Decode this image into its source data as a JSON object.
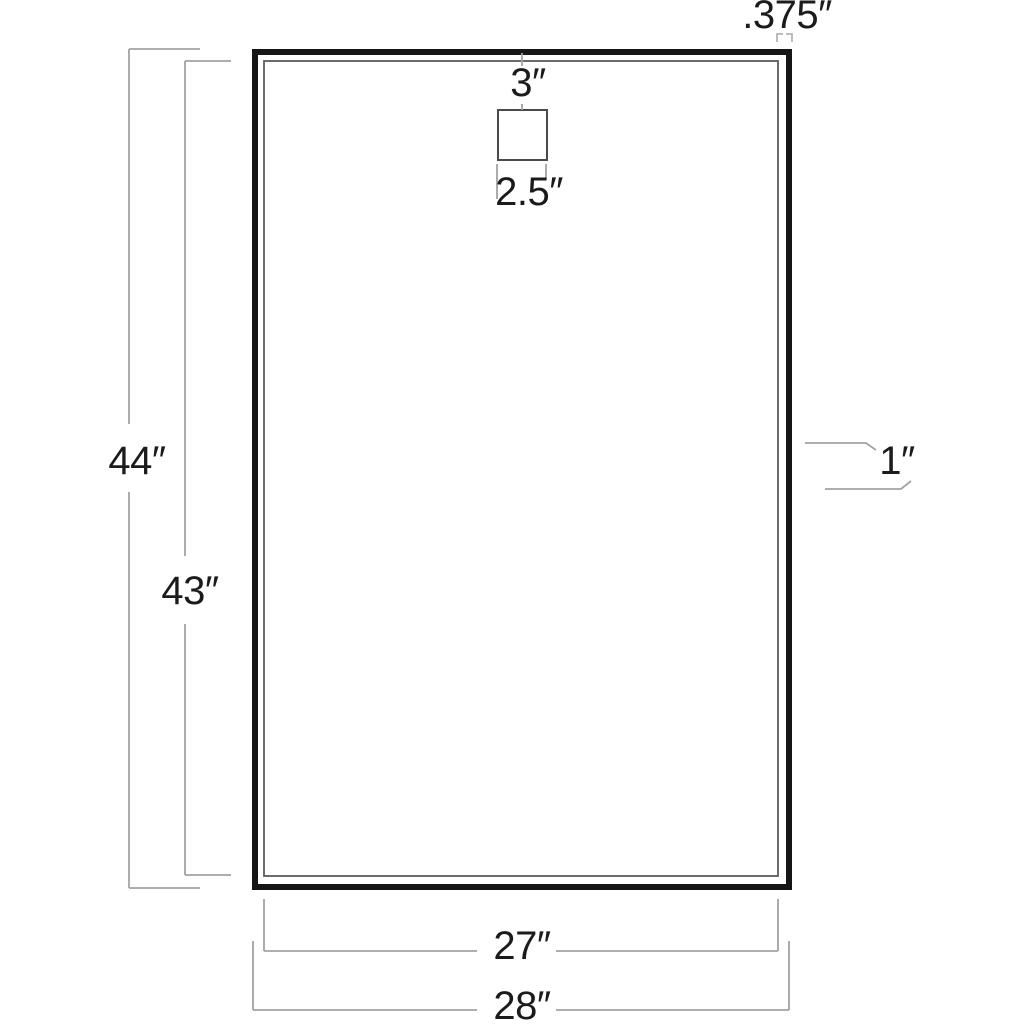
{
  "diagram": {
    "type": "dimension-drawing",
    "background": "#ffffff",
    "colors": {
      "panel_outline": "#161616",
      "inner_line": "#5c5c5c",
      "mount_square": "#4a4a4a",
      "dimension_lines": "#a3a3a3",
      "thickness_ticks": "#b5b5b5",
      "label_text": "#1b1b1b"
    },
    "labels": {
      "frame_thickness": ".375″",
      "mount_offset": "3″",
      "mount_width": "2.5″",
      "overall_height": "44″",
      "inner_height": "43″",
      "edge_inset": "1″",
      "inner_width": "27″",
      "overall_width": "28″"
    }
  }
}
